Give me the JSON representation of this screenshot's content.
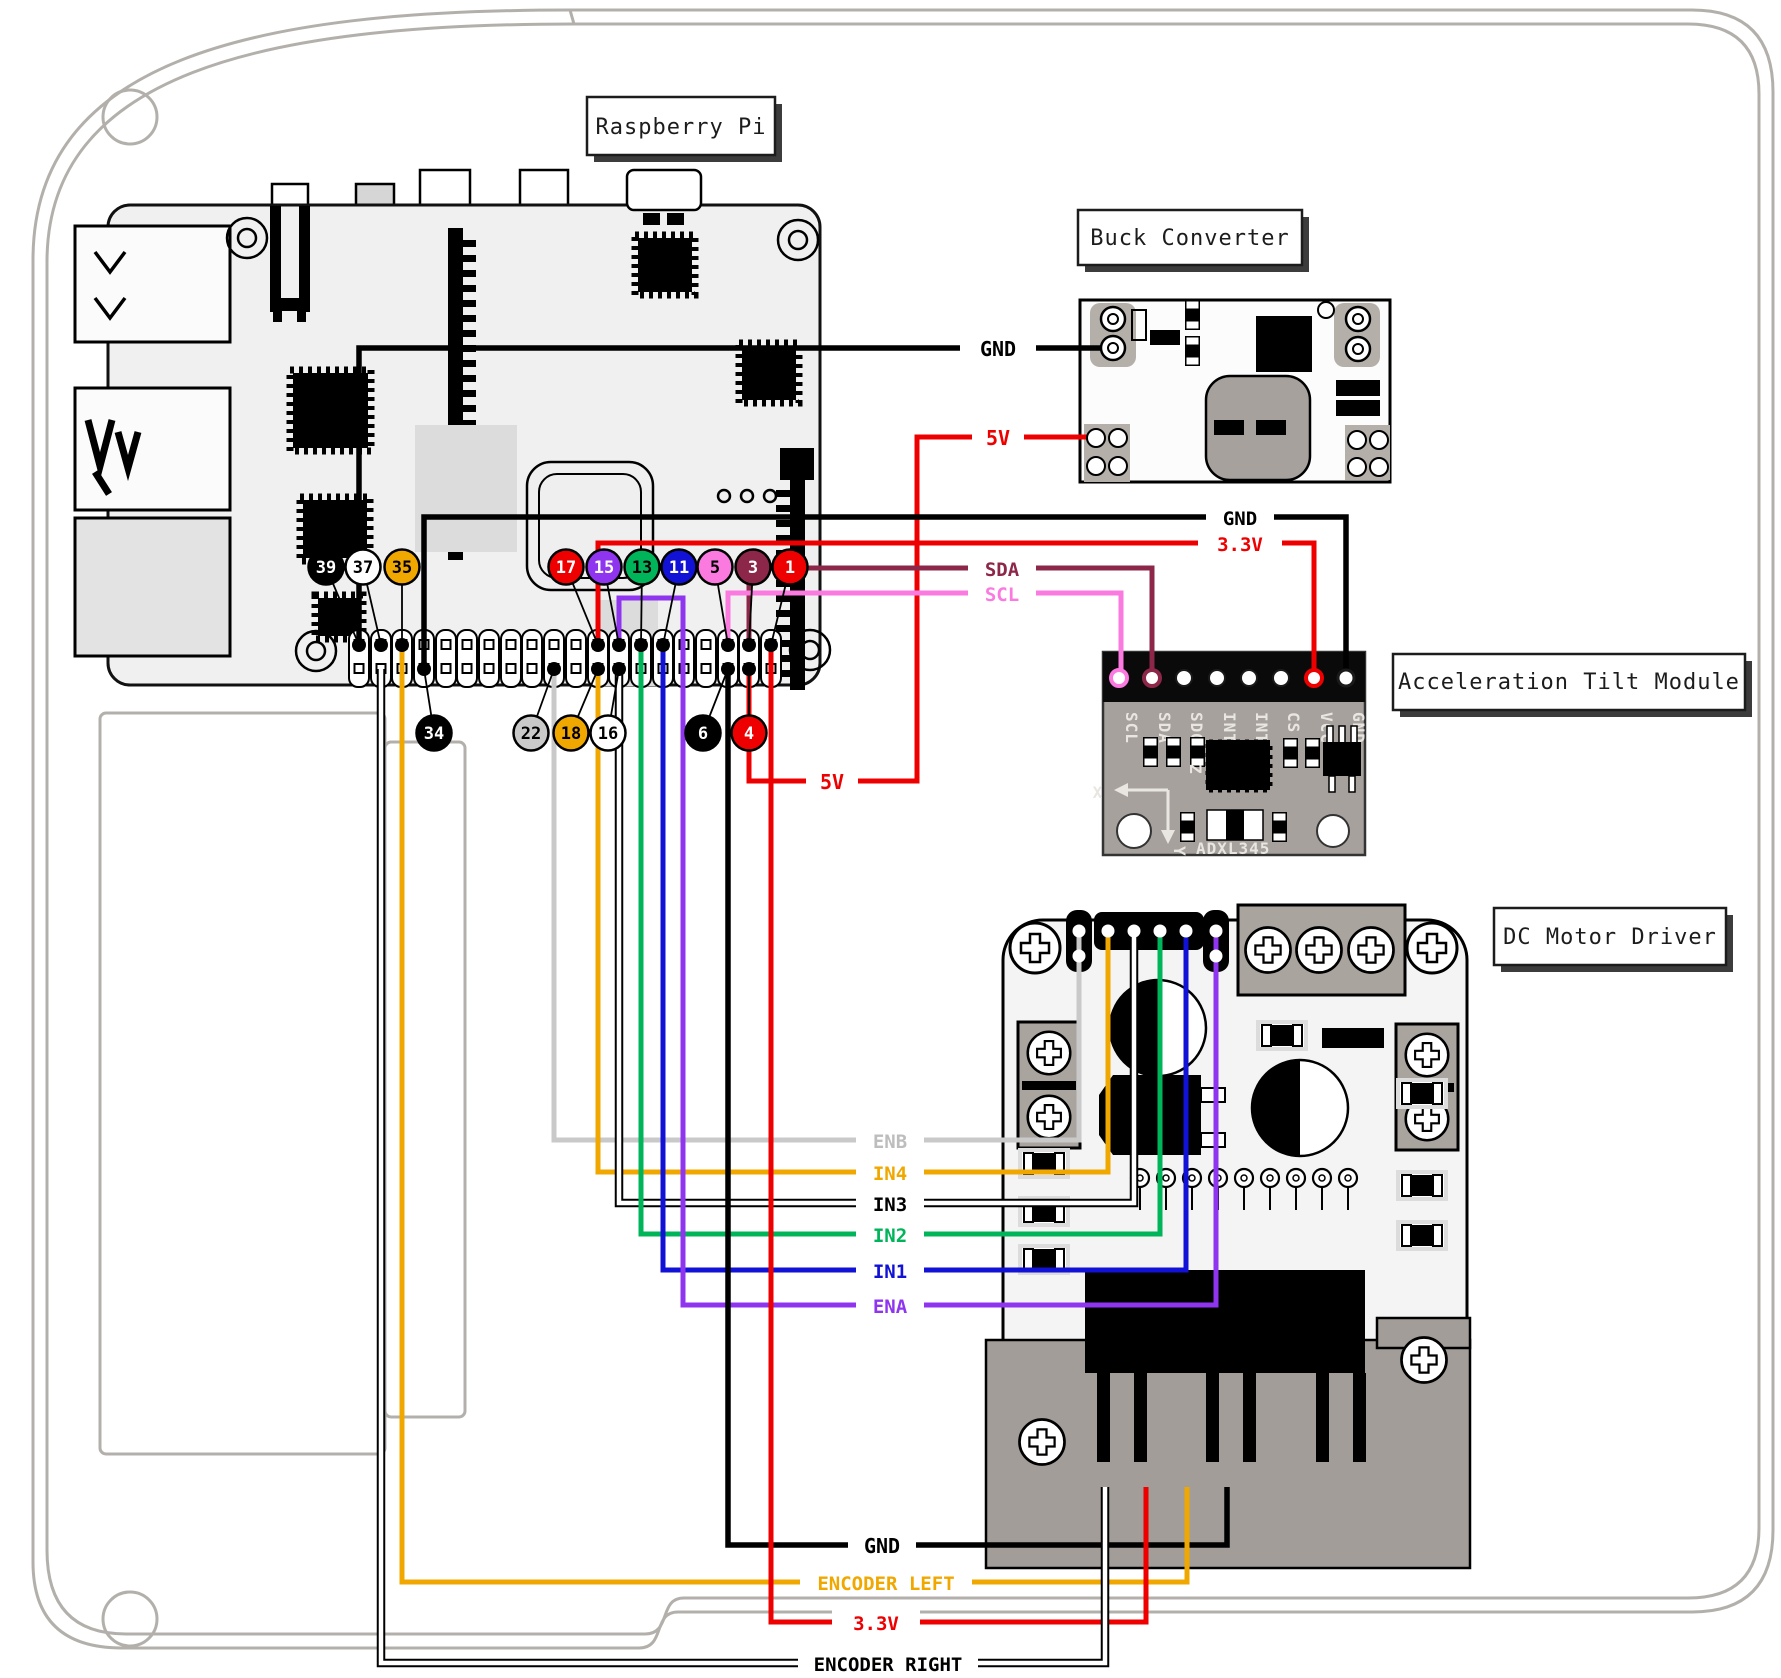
{
  "titles": {
    "raspberry_pi": "Raspberry Pi",
    "buck_converter": "Buck Converter",
    "tilt_module": "Acceleration Tilt Module",
    "motor_driver": "DC Motor Driver"
  },
  "colors": {
    "black": "#000000",
    "white": "#ffffff",
    "red": "#ee0000",
    "orange": "#f0a800",
    "green": "#00b45a",
    "blue": "#1212d6",
    "purple": "#8f35f0",
    "pink": "#fb7ae0",
    "maroon": "#8c2749",
    "gray_wire": "#c9c9c9",
    "gray_label": "#bdbdbd",
    "silkscreen": "#e9e6e2"
  },
  "wire_labels": {
    "gnd_buck": "GND",
    "v5_buck": "5V",
    "gnd_adxl": "GND",
    "v33_adxl": "3.3V",
    "sda": "SDA",
    "scl": "SCL",
    "v5_mid": "5V",
    "enb": "ENB",
    "in4": "IN4",
    "in3": "IN3",
    "in2": "IN2",
    "in1": "IN1",
    "ena": "ENA",
    "gnd_bottom": "GND",
    "encoder_left": "ENCODER LEFT",
    "v33_bottom": "3.3V",
    "encoder_right": "ENCODER RIGHT"
  },
  "gpio_badges": [
    {
      "label": "39",
      "color": "#000000",
      "text": "#ffffff"
    },
    {
      "label": "37",
      "color": "#ffffff",
      "text": "#000000"
    },
    {
      "label": "35",
      "color": "#f0a800",
      "text": "#000000"
    },
    {
      "label": "17",
      "color": "#ee0000",
      "text": "#ffffff"
    },
    {
      "label": "15",
      "color": "#8f35f0",
      "text": "#ffffff"
    },
    {
      "label": "13",
      "color": "#00b45a",
      "text": "#000000"
    },
    {
      "label": "11",
      "color": "#1212d6",
      "text": "#ffffff"
    },
    {
      "label": "5",
      "color": "#fb7ae0",
      "text": "#000000"
    },
    {
      "label": "3",
      "color": "#8c2749",
      "text": "#ffffff"
    },
    {
      "label": "1",
      "color": "#ee0000",
      "text": "#ffffff"
    },
    {
      "label": "34",
      "color": "#000000",
      "text": "#ffffff"
    },
    {
      "label": "22",
      "color": "#c9c9c9",
      "text": "#000000"
    },
    {
      "label": "18",
      "color": "#f0a800",
      "text": "#000000"
    },
    {
      "label": "16",
      "color": "#ffffff",
      "text": "#000000"
    },
    {
      "label": "6",
      "color": "#000000",
      "text": "#ffffff"
    },
    {
      "label": "4",
      "color": "#ee0000",
      "text": "#ffffff"
    }
  ],
  "adxl": {
    "pins": [
      "SCL",
      "SDA",
      "SDO",
      "INT2",
      "INT1",
      "CS",
      "VCC",
      "GND"
    ],
    "chip_label": "ADXL345",
    "axis": {
      "x": "X",
      "y": "Y",
      "z": "Z"
    }
  },
  "connections": [
    {
      "label": "GND",
      "color": "black",
      "from": "Pi pin 39",
      "to": "Buck Converter GND"
    },
    {
      "label": "5V",
      "color": "red",
      "from": "Pi pin 4",
      "to": "Buck Converter 5V"
    },
    {
      "label": "GND",
      "color": "black",
      "from": "Pi pin 34",
      "to": "Tilt Module GND"
    },
    {
      "label": "3.3V",
      "color": "red",
      "from": "Pi pin 17",
      "to": "Tilt Module VCC"
    },
    {
      "label": "SDA",
      "color": "maroon",
      "from": "Pi pin 3",
      "to": "Tilt Module SDA"
    },
    {
      "label": "SCL",
      "color": "pink",
      "from": "Pi pin 5",
      "to": "Tilt Module SCL"
    },
    {
      "label": "ENB",
      "color": "gray",
      "from": "Pi pin 22",
      "to": "Motor Driver ENB"
    },
    {
      "label": "IN4",
      "color": "orange",
      "from": "Pi pin 18",
      "to": "Motor Driver IN4"
    },
    {
      "label": "IN3",
      "color": "white",
      "from": "Pi pin 16",
      "to": "Motor Driver IN3"
    },
    {
      "label": "IN2",
      "color": "green",
      "from": "Pi pin 13",
      "to": "Motor Driver IN2"
    },
    {
      "label": "IN1",
      "color": "blue",
      "from": "Pi pin 11",
      "to": "Motor Driver IN1"
    },
    {
      "label": "ENA",
      "color": "purple",
      "from": "Pi pin 15",
      "to": "Motor Driver ENA"
    },
    {
      "label": "GND",
      "color": "black",
      "from": "Pi pin 6",
      "to": "Motor connector"
    },
    {
      "label": "ENCODER LEFT",
      "color": "orange",
      "from": "Pi pin 35",
      "to": "Motor connector"
    },
    {
      "label": "3.3V",
      "color": "red",
      "from": "Pi pin 1",
      "to": "Motor connector"
    },
    {
      "label": "ENCODER RIGHT",
      "color": "white",
      "from": "Pi pin 37",
      "to": "Motor connector"
    }
  ]
}
